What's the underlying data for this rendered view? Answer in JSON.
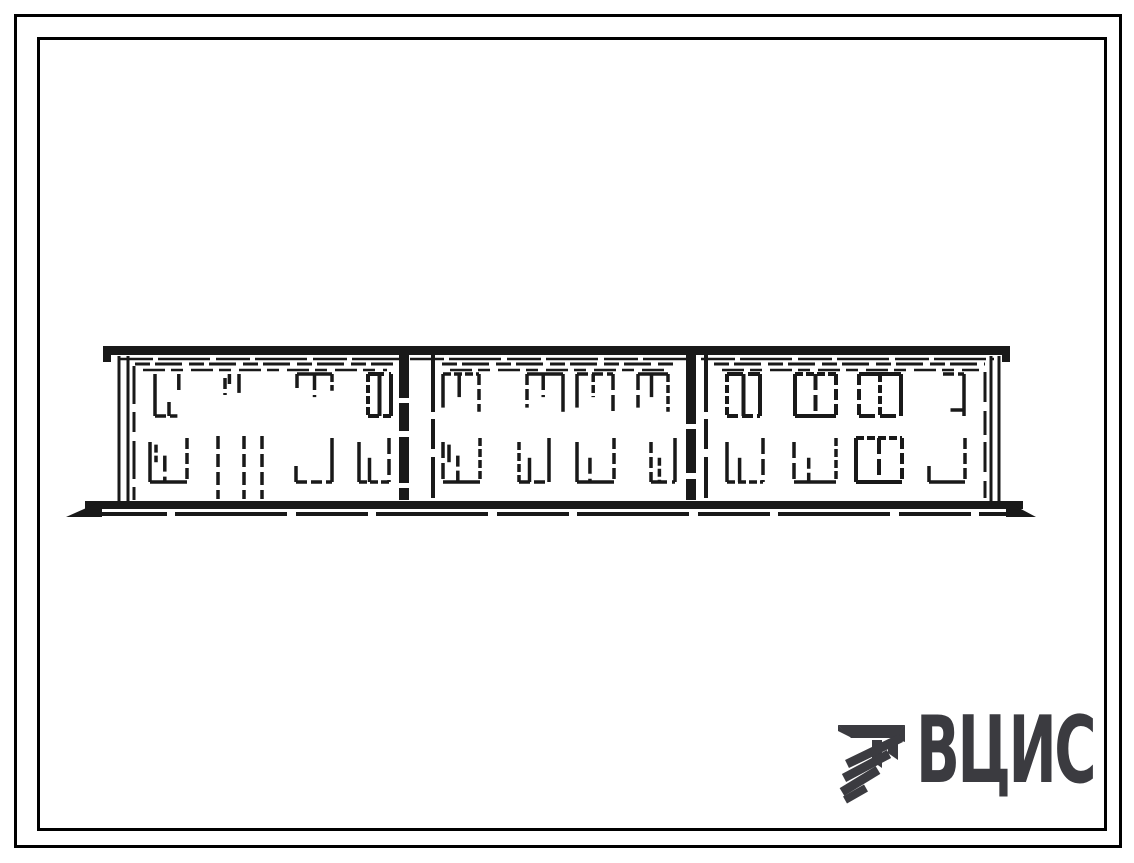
{
  "page": {
    "background": "#ffffff",
    "outer_border_color": "#000000",
    "inner_border_color": "#000000"
  },
  "logo": {
    "text": "ВЦИС",
    "color": "#3b3b40",
    "emblem": "hatched-triangle-emblem"
  },
  "drawing": {
    "ink": "#191919",
    "kind": "building-elevation-sketch",
    "building": {
      "floors": 2,
      "sections": 3,
      "roof": {
        "x1": 103,
        "x2": 1010,
        "y": 346,
        "h": 9
      },
      "roof_underline_y": 359,
      "ground": {
        "x1": 66,
        "x2": 1036,
        "y": 501
      },
      "end_posts": [
        [
          119,
          128
        ],
        [
          991,
          999
        ]
      ],
      "wall_edges": [
        134,
        985
      ],
      "joints": [
        {
          "a": 404,
          "b": 433
        },
        {
          "a": 691,
          "b": 706
        }
      ],
      "frieze_rows": [
        [
          135,
          393
        ],
        [
          442,
          676
        ],
        [
          714,
          985
        ]
      ],
      "upper_row": {
        "y": 374,
        "h": 42
      },
      "lower_row": {
        "y": 438,
        "h": 44
      },
      "upper_windows": [
        {
          "x": 155,
          "w": 28,
          "s": "lb"
        },
        {
          "x": 219,
          "w": 26,
          "s": "ticks"
        },
        {
          "x": 297,
          "w": 35,
          "s": "tm"
        },
        {
          "x": 368,
          "w": 23,
          "s": "full2"
        },
        {
          "x": 443,
          "w": 36,
          "s": "pi"
        },
        {
          "x": 527,
          "w": 36,
          "s": "pi"
        },
        {
          "x": 577,
          "w": 36,
          "s": "pi"
        },
        {
          "x": 638,
          "w": 30,
          "s": "pi"
        },
        {
          "x": 727,
          "w": 33,
          "s": "full2"
        },
        {
          "x": 795,
          "w": 41,
          "s": "full2"
        },
        {
          "x": 859,
          "w": 42,
          "s": "full2"
        },
        {
          "x": 934,
          "w": 30,
          "s": "tr"
        }
      ],
      "lower_windows": [
        {
          "x": 150,
          "w": 37,
          "s": "u2"
        },
        {
          "x": 296,
          "w": 36,
          "s": "br"
        },
        {
          "x": 359,
          "w": 30,
          "s": "u"
        },
        {
          "x": 443,
          "w": 37,
          "s": "u2"
        },
        {
          "x": 519,
          "w": 30,
          "s": "u"
        },
        {
          "x": 577,
          "w": 37,
          "s": "u"
        },
        {
          "x": 651,
          "w": 24,
          "s": "u"
        },
        {
          "x": 727,
          "w": 36,
          "s": "u"
        },
        {
          "x": 794,
          "w": 42,
          "s": "u"
        },
        {
          "x": 856,
          "w": 46,
          "s": "full2"
        },
        {
          "x": 929,
          "w": 36,
          "s": "br"
        }
      ],
      "door_lines": [
        218,
        244,
        262
      ]
    }
  }
}
